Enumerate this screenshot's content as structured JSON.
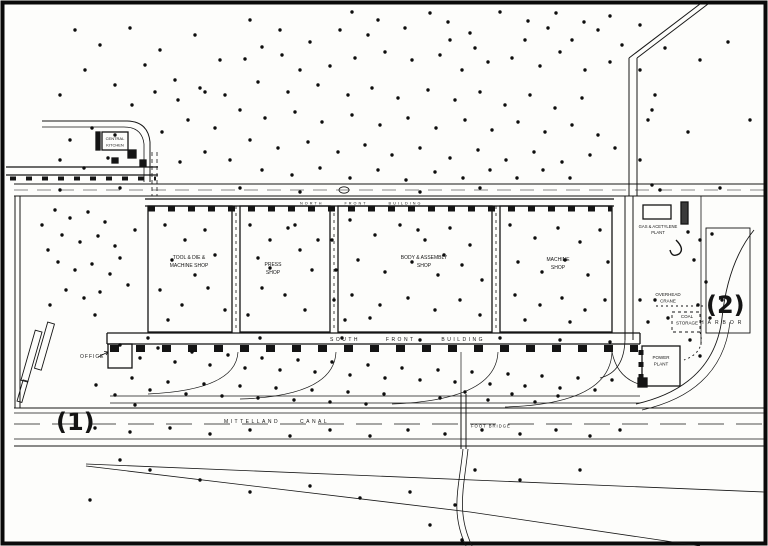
{
  "figure": {
    "background": "#fdfdfb",
    "ink": "#141414",
    "annotation_color": "#df261c"
  },
  "annotations": {
    "marker_1": "(1)",
    "marker_2": "(2)"
  },
  "labels": {
    "central_kitchen": [
      "CENTRAL",
      "KITCHEN"
    ],
    "north_front": "NORTH FRONT BUILDING",
    "tool_die": [
      "TOOL & DIE &",
      "MACHINE SHOP"
    ],
    "press": [
      "PRESS",
      "SHOP"
    ],
    "body_assembly": [
      "BODY & ASSEMBLY",
      "SHOP"
    ],
    "machine": [
      "MACHINE",
      "SHOP"
    ],
    "gas_plant": [
      "GAS & ACETYLENE",
      "PLANT"
    ],
    "overhead_crane": [
      "OVERHEAD",
      "CRANE"
    ],
    "coal_storage": [
      "COAL",
      "STORAGE"
    ],
    "power_plant": [
      "POWER",
      "PLANT"
    ],
    "south_front": "SOUTH FRONT BUILDING",
    "office": "OFFICE",
    "canal": "MITTELLAND CANAL",
    "foot_bridge": "FOOT BRIDGE",
    "harbor": "HARBOR"
  },
  "map": {
    "dots": [
      [
        352,
        12
      ],
      [
        430,
        13
      ],
      [
        500,
        12
      ],
      [
        556,
        13
      ],
      [
        584,
        22
      ],
      [
        610,
        16
      ],
      [
        448,
        22
      ],
      [
        378,
        20
      ],
      [
        528,
        21
      ],
      [
        405,
        28
      ],
      [
        470,
        33
      ],
      [
        340,
        30
      ],
      [
        282,
        55
      ],
      [
        262,
        47
      ],
      [
        310,
        42
      ],
      [
        368,
        35
      ],
      [
        525,
        40
      ],
      [
        548,
        28
      ],
      [
        598,
        30
      ],
      [
        622,
        45
      ],
      [
        450,
        40
      ],
      [
        475,
        48
      ],
      [
        572,
        40
      ],
      [
        245,
        59
      ],
      [
        300,
        70
      ],
      [
        330,
        66
      ],
      [
        355,
        58
      ],
      [
        385,
        52
      ],
      [
        412,
        60
      ],
      [
        440,
        55
      ],
      [
        462,
        70
      ],
      [
        488,
        62
      ],
      [
        512,
        58
      ],
      [
        540,
        66
      ],
      [
        560,
        52
      ],
      [
        585,
        70
      ],
      [
        610,
        62
      ],
      [
        258,
        82
      ],
      [
        288,
        92
      ],
      [
        318,
        85
      ],
      [
        348,
        95
      ],
      [
        372,
        88
      ],
      [
        398,
        98
      ],
      [
        428,
        90
      ],
      [
        455,
        100
      ],
      [
        480,
        92
      ],
      [
        505,
        105
      ],
      [
        530,
        95
      ],
      [
        555,
        108
      ],
      [
        582,
        98
      ],
      [
        225,
        95
      ],
      [
        200,
        88
      ],
      [
        178,
        100
      ],
      [
        155,
        92
      ],
      [
        132,
        105
      ],
      [
        240,
        110
      ],
      [
        265,
        118
      ],
      [
        295,
        112
      ],
      [
        322,
        122
      ],
      [
        352,
        115
      ],
      [
        380,
        125
      ],
      [
        408,
        118
      ],
      [
        436,
        128
      ],
      [
        465,
        120
      ],
      [
        492,
        130
      ],
      [
        518,
        122
      ],
      [
        545,
        132
      ],
      [
        572,
        125
      ],
      [
        598,
        135
      ],
      [
        215,
        128
      ],
      [
        188,
        120
      ],
      [
        162,
        132
      ],
      [
        115,
        135
      ],
      [
        92,
        128
      ],
      [
        70,
        140
      ],
      [
        250,
        140
      ],
      [
        278,
        148
      ],
      [
        308,
        142
      ],
      [
        338,
        152
      ],
      [
        365,
        145
      ],
      [
        392,
        155
      ],
      [
        420,
        148
      ],
      [
        450,
        158
      ],
      [
        478,
        150
      ],
      [
        506,
        160
      ],
      [
        534,
        152
      ],
      [
        562,
        162
      ],
      [
        590,
        155
      ],
      [
        615,
        148
      ],
      [
        230,
        160
      ],
      [
        205,
        152
      ],
      [
        180,
        162
      ],
      [
        108,
        158
      ],
      [
        84,
        168
      ],
      [
        60,
        160
      ],
      [
        262,
        170
      ],
      [
        292,
        175
      ],
      [
        320,
        168
      ],
      [
        350,
        178
      ],
      [
        378,
        170
      ],
      [
        406,
        180
      ],
      [
        435,
        172
      ],
      [
        463,
        178
      ],
      [
        490,
        170
      ],
      [
        517,
        178
      ],
      [
        543,
        170
      ],
      [
        570,
        178
      ],
      [
        75,
        30
      ],
      [
        100,
        45
      ],
      [
        130,
        28
      ],
      [
        160,
        50
      ],
      [
        195,
        35
      ],
      [
        220,
        60
      ],
      [
        85,
        70
      ],
      [
        115,
        85
      ],
      [
        145,
        65
      ],
      [
        175,
        80
      ],
      [
        205,
        92
      ],
      [
        60,
        95
      ],
      [
        250,
        20
      ],
      [
        280,
        30
      ],
      [
        640,
        25
      ],
      [
        665,
        48
      ],
      [
        700,
        60
      ],
      [
        728,
        42
      ],
      [
        652,
        110
      ],
      [
        688,
        132
      ],
      [
        640,
        70
      ],
      [
        655,
        95
      ],
      [
        648,
        120
      ],
      [
        750,
        120
      ],
      [
        55,
        210
      ],
      [
        70,
        218
      ],
      [
        88,
        212
      ],
      [
        105,
        222
      ],
      [
        62,
        235
      ],
      [
        80,
        242
      ],
      [
        98,
        236
      ],
      [
        115,
        246
      ],
      [
        58,
        262
      ],
      [
        75,
        270
      ],
      [
        92,
        264
      ],
      [
        110,
        274
      ],
      [
        66,
        290
      ],
      [
        84,
        298
      ],
      [
        100,
        292
      ],
      [
        48,
        250
      ],
      [
        120,
        258
      ],
      [
        135,
        230
      ],
      [
        42,
        225
      ],
      [
        128,
        285
      ],
      [
        50,
        305
      ],
      [
        95,
        315
      ],
      [
        165,
        225
      ],
      [
        185,
        240
      ],
      [
        205,
        230
      ],
      [
        172,
        260
      ],
      [
        195,
        275
      ],
      [
        215,
        255
      ],
      [
        160,
        290
      ],
      [
        182,
        305
      ],
      [
        208,
        288
      ],
      [
        225,
        310
      ],
      [
        168,
        320
      ],
      [
        250,
        225
      ],
      [
        270,
        240
      ],
      [
        288,
        228
      ],
      [
        258,
        258
      ],
      [
        300,
        250
      ],
      [
        312,
        270
      ],
      [
        262,
        288
      ],
      [
        285,
        295
      ],
      [
        305,
        310
      ],
      [
        248,
        315
      ],
      [
        295,
        225
      ],
      [
        318,
        240
      ],
      [
        270,
        268
      ],
      [
        350,
        220
      ],
      [
        375,
        235
      ],
      [
        400,
        225
      ],
      [
        425,
        240
      ],
      [
        450,
        228
      ],
      [
        470,
        245
      ],
      [
        358,
        260
      ],
      [
        385,
        272
      ],
      [
        412,
        262
      ],
      [
        438,
        275
      ],
      [
        462,
        265
      ],
      [
        482,
        280
      ],
      [
        352,
        295
      ],
      [
        380,
        305
      ],
      [
        408,
        298
      ],
      [
        435,
        310
      ],
      [
        460,
        300
      ],
      [
        480,
        315
      ],
      [
        345,
        320
      ],
      [
        370,
        318
      ],
      [
        418,
        230
      ],
      [
        444,
        255
      ],
      [
        332,
        240
      ],
      [
        336,
        270
      ],
      [
        334,
        300
      ],
      [
        510,
        225
      ],
      [
        535,
        238
      ],
      [
        558,
        228
      ],
      [
        580,
        242
      ],
      [
        600,
        230
      ],
      [
        518,
        262
      ],
      [
        542,
        272
      ],
      [
        565,
        260
      ],
      [
        588,
        275
      ],
      [
        608,
        262
      ],
      [
        515,
        295
      ],
      [
        540,
        305
      ],
      [
        562,
        298
      ],
      [
        585,
        310
      ],
      [
        605,
        300
      ],
      [
        525,
        320
      ],
      [
        570,
        322
      ],
      [
        120,
        345
      ],
      [
        140,
        358
      ],
      [
        158,
        348
      ],
      [
        175,
        362
      ],
      [
        192,
        352
      ],
      [
        210,
        365
      ],
      [
        228,
        355
      ],
      [
        245,
        368
      ],
      [
        262,
        358
      ],
      [
        280,
        370
      ],
      [
        298,
        360
      ],
      [
        315,
        372
      ],
      [
        332,
        362
      ],
      [
        350,
        375
      ],
      [
        368,
        365
      ],
      [
        385,
        378
      ],
      [
        402,
        368
      ],
      [
        420,
        380
      ],
      [
        438,
        370
      ],
      [
        455,
        382
      ],
      [
        472,
        372
      ],
      [
        490,
        384
      ],
      [
        508,
        374
      ],
      [
        525,
        386
      ],
      [
        542,
        376
      ],
      [
        560,
        388
      ],
      [
        578,
        378
      ],
      [
        595,
        390
      ],
      [
        612,
        380
      ],
      [
        132,
        378
      ],
      [
        150,
        390
      ],
      [
        168,
        382
      ],
      [
        186,
        394
      ],
      [
        204,
        384
      ],
      [
        222,
        396
      ],
      [
        240,
        386
      ],
      [
        258,
        398
      ],
      [
        276,
        388
      ],
      [
        294,
        400
      ],
      [
        312,
        390
      ],
      [
        330,
        402
      ],
      [
        348,
        392
      ],
      [
        366,
        404
      ],
      [
        384,
        394
      ],
      [
        148,
        338
      ],
      [
        260,
        338
      ],
      [
        342,
        338
      ],
      [
        420,
        340
      ],
      [
        500,
        338
      ],
      [
        560,
        340
      ],
      [
        610,
        342
      ],
      [
        115,
        395
      ],
      [
        96,
        385
      ],
      [
        135,
        405
      ],
      [
        440,
        398
      ],
      [
        465,
        392
      ],
      [
        488,
        400
      ],
      [
        512,
        394
      ],
      [
        535,
        402
      ],
      [
        558,
        396
      ],
      [
        95,
        428
      ],
      [
        130,
        432
      ],
      [
        170,
        428
      ],
      [
        210,
        434
      ],
      [
        250,
        430
      ],
      [
        290,
        436
      ],
      [
        330,
        430
      ],
      [
        370,
        436
      ],
      [
        408,
        430
      ],
      [
        445,
        434
      ],
      [
        482,
        430
      ],
      [
        520,
        434
      ],
      [
        556,
        430
      ],
      [
        590,
        436
      ],
      [
        620,
        430
      ],
      [
        150,
        470
      ],
      [
        200,
        480
      ],
      [
        250,
        492
      ],
      [
        310,
        486
      ],
      [
        360,
        498
      ],
      [
        410,
        492
      ],
      [
        455,
        505
      ],
      [
        120,
        460
      ],
      [
        520,
        480
      ],
      [
        580,
        470
      ],
      [
        90,
        500
      ],
      [
        430,
        525
      ],
      [
        462,
        540
      ],
      [
        475,
        470
      ],
      [
        640,
        160
      ],
      [
        652,
        185
      ],
      [
        688,
        232
      ],
      [
        700,
        240
      ],
      [
        712,
        234
      ],
      [
        694,
        260
      ],
      [
        706,
        282
      ],
      [
        698,
        305
      ],
      [
        710,
        318
      ],
      [
        722,
        300
      ],
      [
        690,
        340
      ],
      [
        655,
        300
      ],
      [
        668,
        318
      ],
      [
        700,
        356
      ],
      [
        640,
        300
      ],
      [
        648,
        322
      ],
      [
        60,
        190
      ],
      [
        120,
        188
      ],
      [
        240,
        188
      ],
      [
        300,
        192
      ],
      [
        420,
        192
      ],
      [
        480,
        188
      ],
      [
        660,
        190
      ],
      [
        720,
        188
      ]
    ]
  }
}
